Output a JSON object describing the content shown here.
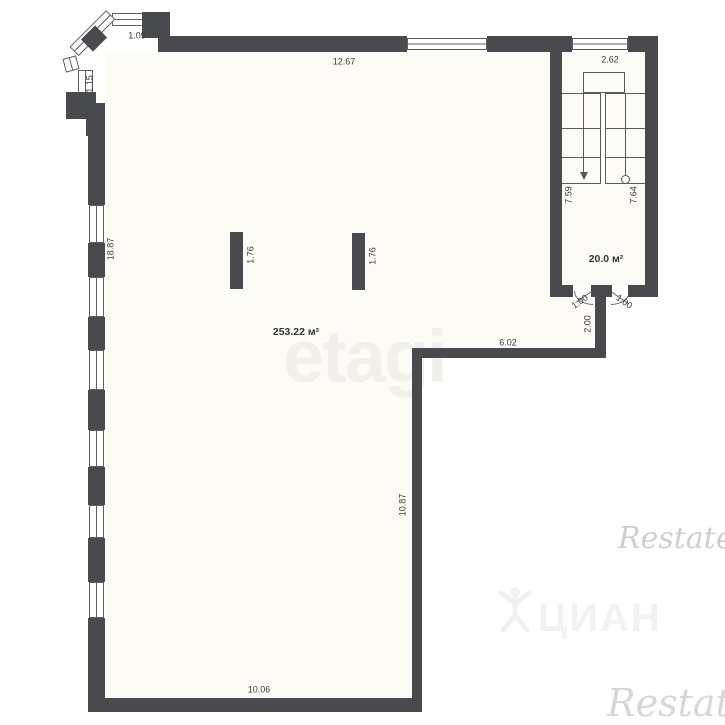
{
  "rooms": {
    "main_area": "253.22 м²",
    "upper_area": "20.0 м²"
  },
  "dims": {
    "d109": "1.09",
    "d1267": "12.67",
    "d262": "2.62",
    "d115": "1.15",
    "d1887": "18.87",
    "col_a": "1.76",
    "col_b": "1.76",
    "d759": "7.59",
    "d764": "7.64",
    "door_a": "1.00",
    "door_b": "1.00",
    "d200": "2.00",
    "d602": "6.02",
    "d1087": "10.87",
    "d1006": "10.06"
  },
  "watermarks": {
    "brand_center": "etagi",
    "brand_cian": "ЦИАН",
    "brand_restate_mid": "Restate",
    "brand_restate_bottom": "Restate"
  },
  "colors": {
    "wall": "#494a4e",
    "thin_line": "#5a5a5a",
    "dimension_text": "#3b3b3b",
    "interior_tint": "#fdfbf6",
    "watermark_etagi": "#f0efe9",
    "watermark_cian": "#f2f2f1",
    "watermark_restate": "#cdd0d3"
  }
}
